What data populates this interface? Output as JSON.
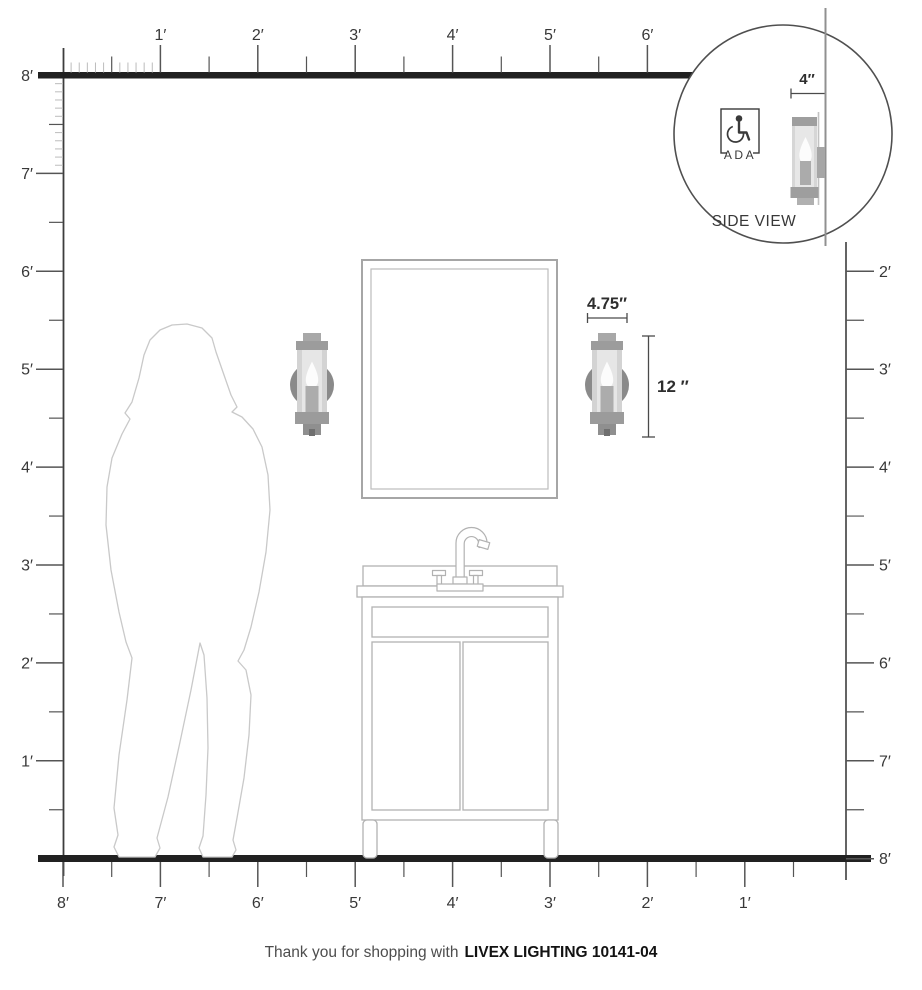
{
  "rulers": {
    "top_labels": [
      "1′",
      "2′",
      "3′",
      "4′",
      "5′",
      "6′"
    ],
    "left_labels": [
      "8′",
      "7′",
      "6′",
      "5′",
      "4′",
      "3′",
      "2′",
      "1′"
    ],
    "right_labels": [
      "2′",
      "3′",
      "4′",
      "5′",
      "6′",
      "7′",
      "8′"
    ],
    "bottom_labels": [
      "8′",
      "7′",
      "6′",
      "5′",
      "4′",
      "3′",
      "2′",
      "1′"
    ]
  },
  "annotations": {
    "sconce_width": "4.75″",
    "sconce_height": "12 ″",
    "inset_depth": "4″"
  },
  "inset": {
    "ada_label": "ADA",
    "caption": "SIDE VIEW"
  },
  "footer": {
    "prefix": "Thank you for shopping with",
    "brand": "LIVEX LIGHTING 10141-04"
  },
  "colors": {
    "ruler_dark": "#212121",
    "tick_gray": "#555555",
    "tick_light": "#bcbcbc",
    "axis_gray": "#3d3d3d",
    "fixture_glass": "#d3d3d3",
    "fixture_metal": "#9c9c9c",
    "fixture_backplate": "#8a8a8a",
    "furniture_outline": "#b2b2b2",
    "silhouette_outline": "#c9c9c9"
  }
}
